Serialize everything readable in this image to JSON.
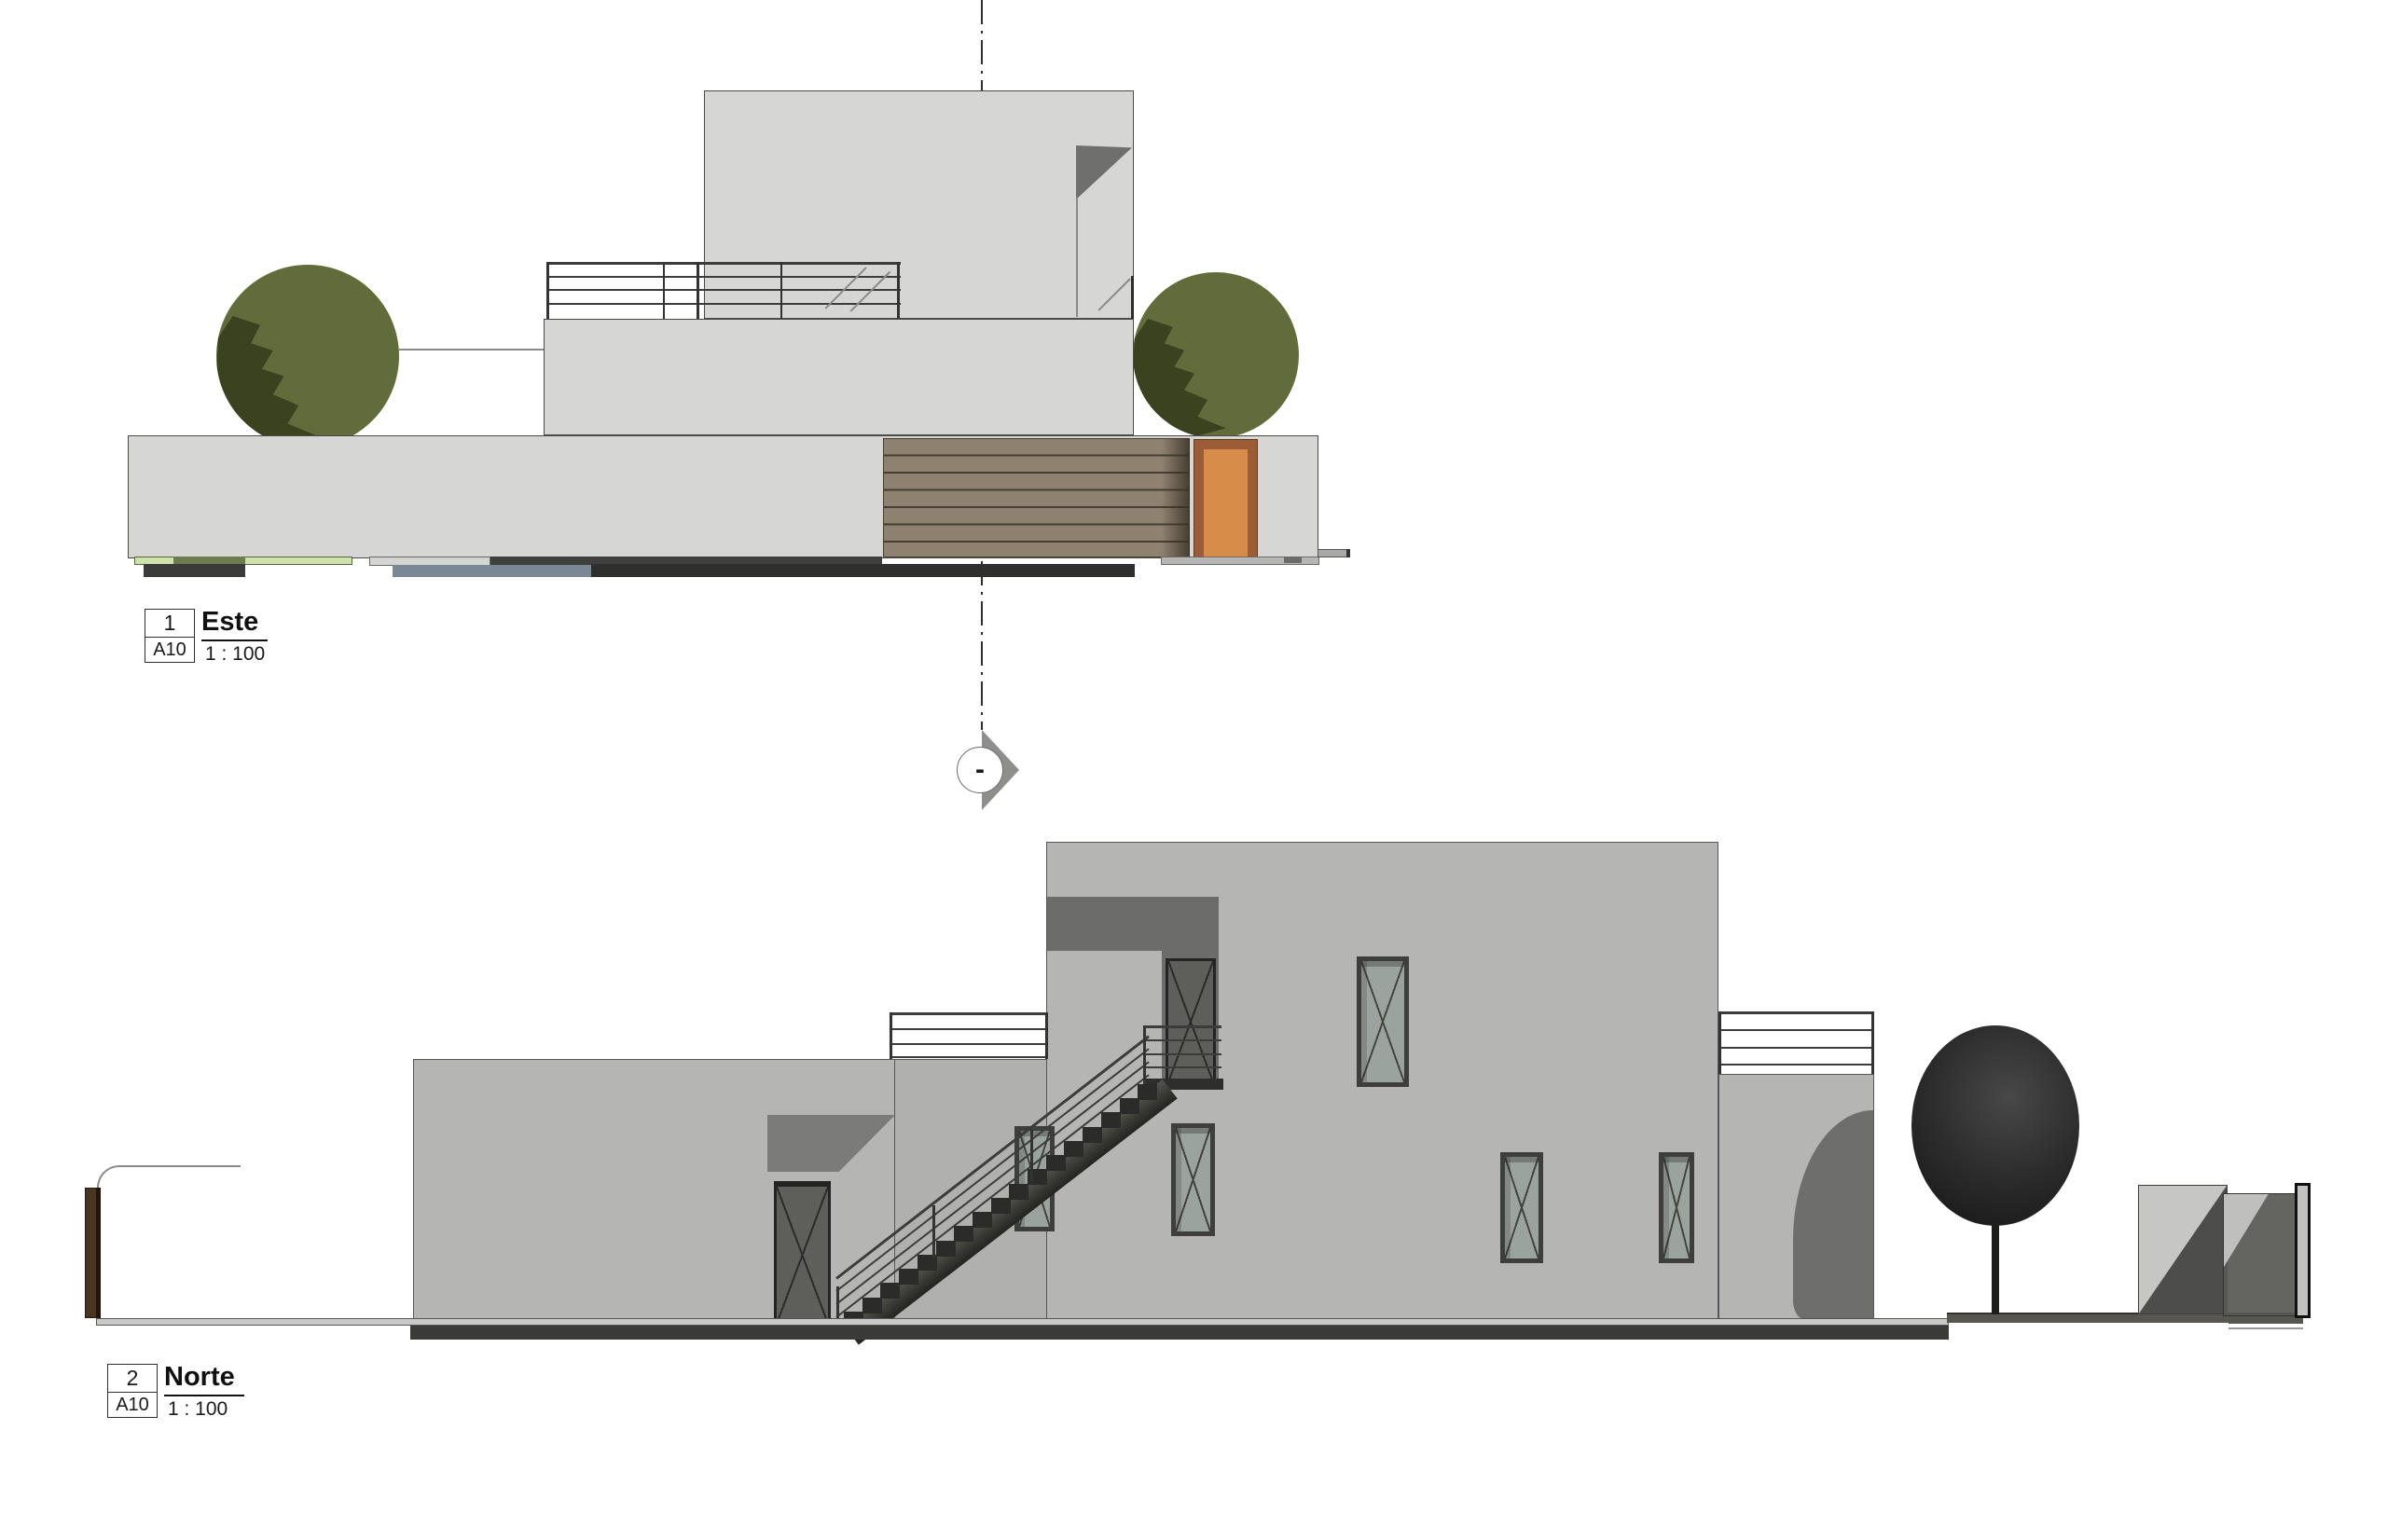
{
  "drawing": {
    "type": "architectural-elevations",
    "sheet_background": "#ffffff",
    "views": {
      "este": {
        "viewport_number": "1",
        "sheet_ref": "A10",
        "title": "Este",
        "scale": "1 : 100",
        "section_marker_text": "-"
      },
      "norte": {
        "viewport_number": "2",
        "sheet_ref": "A10",
        "title": "Norte",
        "scale": "1 : 100"
      }
    },
    "palette": {
      "este_wall": "#d6d6d4",
      "norte_wall": "#b5b5b3",
      "shadow_gray": "#6c6c6a",
      "wood_slats": "#8e8170",
      "wood_slat_line": "#454033",
      "door_orange_panel": "#d88c49",
      "door_orange_frame": "#9c5c36",
      "tree_olive": "#626c3a",
      "tree_olive_shadow": "#3a421f",
      "tree_dark": "#1e1e1e",
      "glass": "#9aa39e",
      "frame_dark": "#3e3e3c",
      "ground_dark_band": "#3a3a38",
      "pavement": "#c9c9c7",
      "strip_green": "#cfe2ab",
      "strip_olive": "#6d7b50",
      "strip_blue_gray": "#7a8795",
      "fence_post_brown": "#4a3422"
    }
  }
}
